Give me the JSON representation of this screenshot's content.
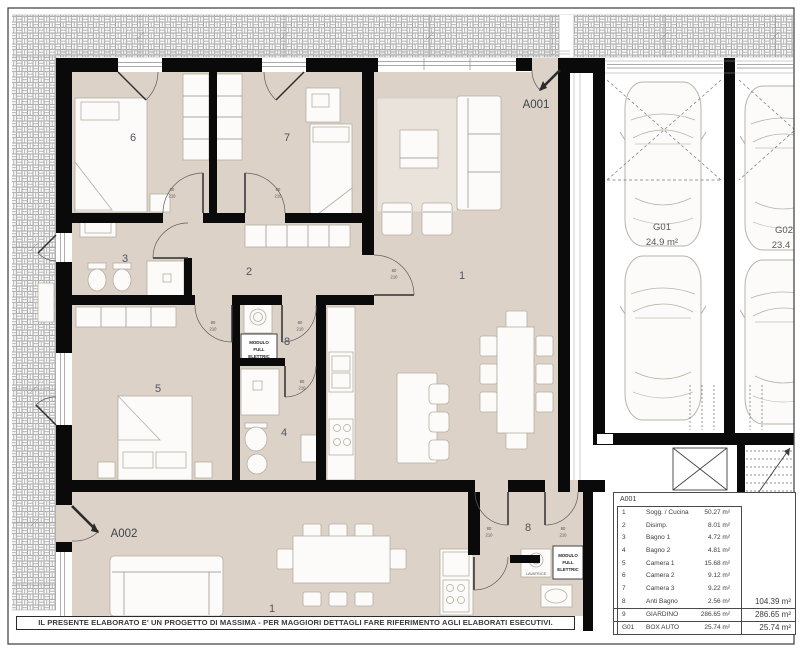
{
  "colors": {
    "floor": "#dcd2c8",
    "wall": "#0a0a0a",
    "hatch_line": "#a8a8a8",
    "label": "#4e5562"
  },
  "plan": {
    "a001_label": "A001",
    "a002_label": "A002",
    "rooms_a001": {
      "living": "1",
      "hall": "2",
      "bath1": "3",
      "bath2": "4",
      "bed1": "5",
      "bed2": "6",
      "bed3": "7",
      "antibath": "8"
    },
    "rooms_a002": {
      "living": "1",
      "room8": "8"
    },
    "modulo_lines": [
      "MODULO",
      "FULL",
      "ELETTRIC"
    ],
    "lavatrice": "LAVATRICE",
    "door_w": "80",
    "door_h": "210"
  },
  "garage": {
    "g01_label": "G01",
    "g01_area": "24.9 m²",
    "g02_label": "G02",
    "g02_area": "23.4"
  },
  "schedule": {
    "title": "A001",
    "rows": [
      {
        "num": "1",
        "name": "Sogg. / Cucina",
        "area": "50.27 m²",
        "total": ""
      },
      {
        "num": "2",
        "name": "Disimp.",
        "area": "8.01 m²",
        "total": ""
      },
      {
        "num": "3",
        "name": "Bagno 1",
        "area": "4.72 m²",
        "total": ""
      },
      {
        "num": "4",
        "name": "Bagno 2",
        "area": "4.81 m²",
        "total": ""
      },
      {
        "num": "5",
        "name": "Camera 1",
        "area": "15.68 m²",
        "total": ""
      },
      {
        "num": "6",
        "name": "Camera 2",
        "area": "9.12 m²",
        "total": ""
      },
      {
        "num": "7",
        "name": "Camera 3",
        "area": "9.22 m²",
        "total": ""
      },
      {
        "num": "8",
        "name": "Anti Bagno",
        "area": "2.56 m²",
        "total": "104.39 m²"
      },
      {
        "num": "9",
        "name": "GIARDINO",
        "area": "286.65 m²",
        "total": "286.65 m²"
      },
      {
        "num": "G01",
        "name": "BOX AUTO",
        "area": "25.74 m²",
        "total": "25.74 m²"
      }
    ]
  },
  "disclaimer": "IL PRESENTE ELABORATO E' UN PROGETTO DI MASSIMA - PER MAGGIORI DETTAGLI FARE RIFERIMENTO AGLI ELABORATI ESECUTIVI."
}
